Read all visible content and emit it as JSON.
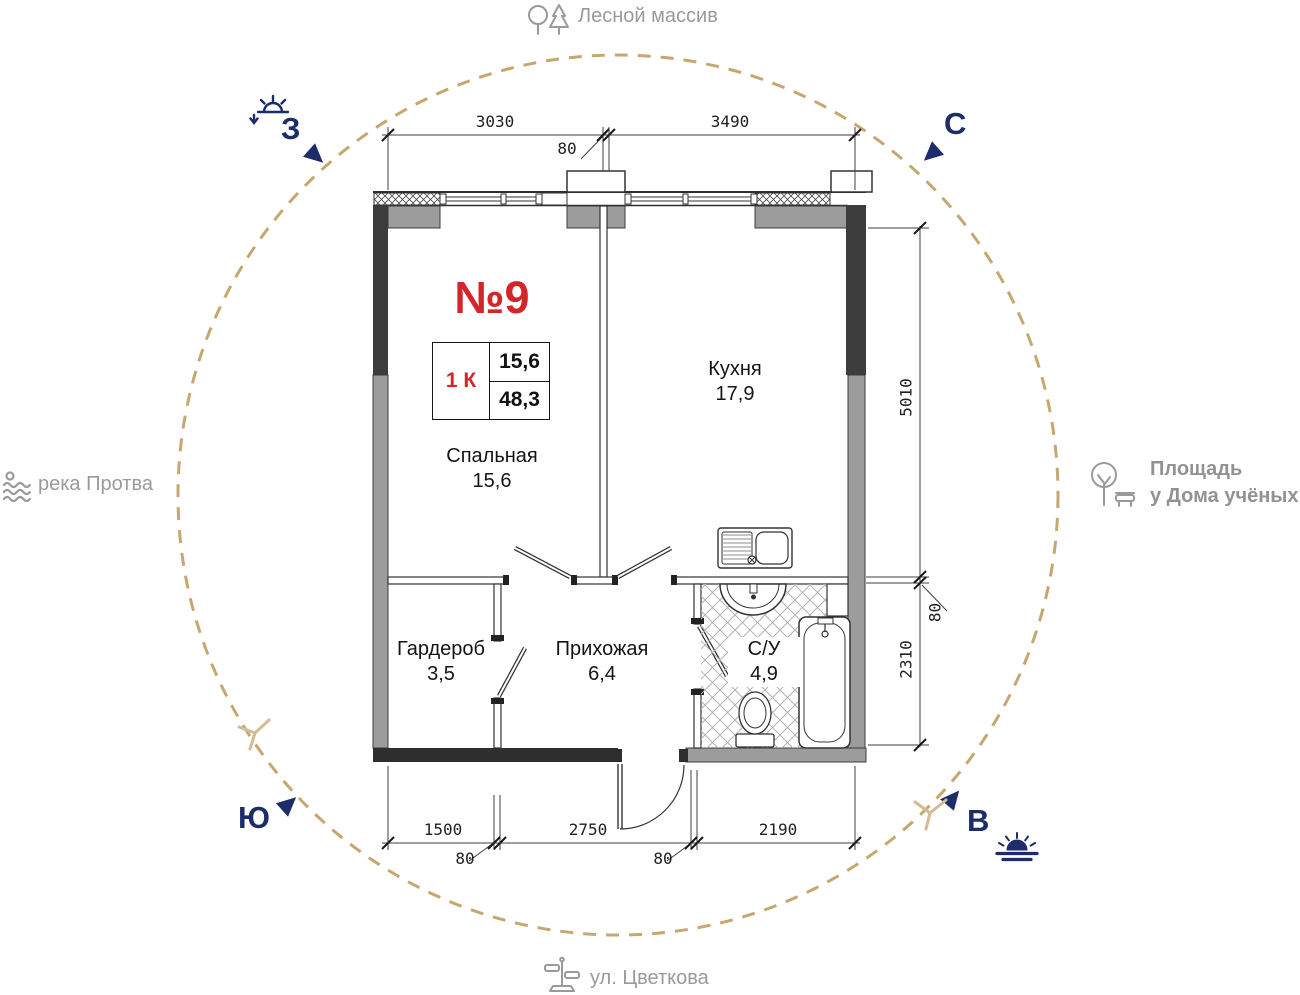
{
  "compass": {
    "north": "С",
    "west": "З",
    "south": "Ю",
    "east": "В"
  },
  "landmarks": {
    "forest": "Лесной массив",
    "river": "река Протва",
    "square_line1": "Площадь",
    "square_line2": "у Дома учёных",
    "street": "ул. Цветкова"
  },
  "apartment": {
    "number": "№9",
    "rooms_type": "1 К",
    "living_area": "15,6",
    "total_area": "48,3"
  },
  "rooms": [
    {
      "name": "Спальная",
      "area": "15,6"
    },
    {
      "name": "Кухня",
      "area": "17,9"
    },
    {
      "name": "Гардероб",
      "area": "3,5"
    },
    {
      "name": "Прихожая",
      "area": "6,4"
    },
    {
      "name": "С/У",
      "area": "4,9"
    }
  ],
  "dimensions": {
    "top_left": "3030",
    "top_right": "3490",
    "top_offset": "80",
    "right_upper": "5010",
    "right_lower": "2310",
    "right_offset": "80",
    "bottom_left": "1500",
    "bottom_middle": "2750",
    "bottom_right": "2190",
    "bottom_offset_1": "80",
    "bottom_offset_2": "80"
  },
  "colors": {
    "accent_red": "#d3262a",
    "navy": "#1d2d6b",
    "circle_tan": "#c7a770",
    "label_gray": "#9a9a9a",
    "wall_dark": "#3c3c3c",
    "wall_gray": "#9c9c9c"
  }
}
